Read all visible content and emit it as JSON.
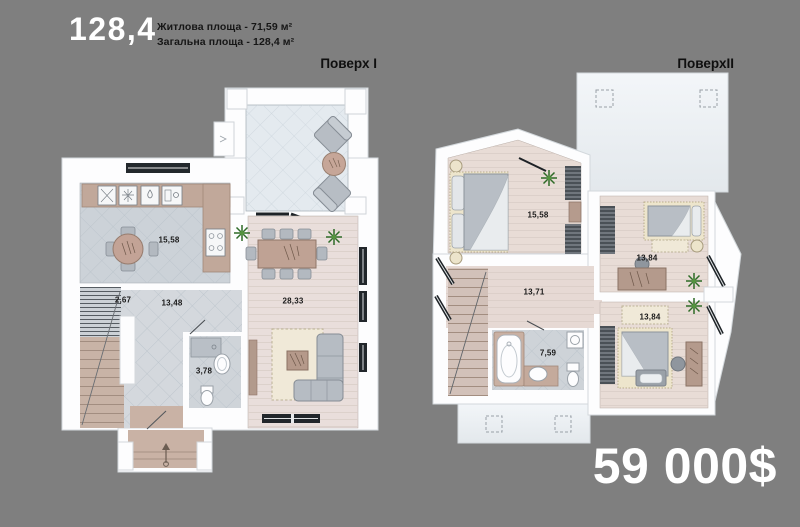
{
  "header": {
    "area_headline": "128,4",
    "living_area_line": "Житлова площа - 71,59 м²",
    "total_area_line": "Загальна площа - 128,4 м²"
  },
  "floor1": {
    "label": "Поверх I",
    "rooms": {
      "kitchen": "15,58",
      "stairs": "2,67",
      "hallway": "13,48",
      "living_room": "28,33",
      "bathroom": "3,78"
    }
  },
  "floor2": {
    "label": "ПоверхII",
    "rooms": {
      "bedroom_left": "15,58",
      "bedroom_top_right": "13,84",
      "hallway": "13,71",
      "bathroom": "7,59",
      "bedroom_bottom_right": "13,84"
    }
  },
  "price": "59 000$",
  "colors": {
    "background": "#7f7f7f",
    "walls": "#fdfdfe",
    "text_dark": "#1a1a1a",
    "text_light": "#ffffff",
    "floor_wood": "#e9dedb",
    "floor_tile": "#ccd2d8",
    "furniture_wood": "#c0a79a",
    "plant_green": "#2e6b27"
  }
}
